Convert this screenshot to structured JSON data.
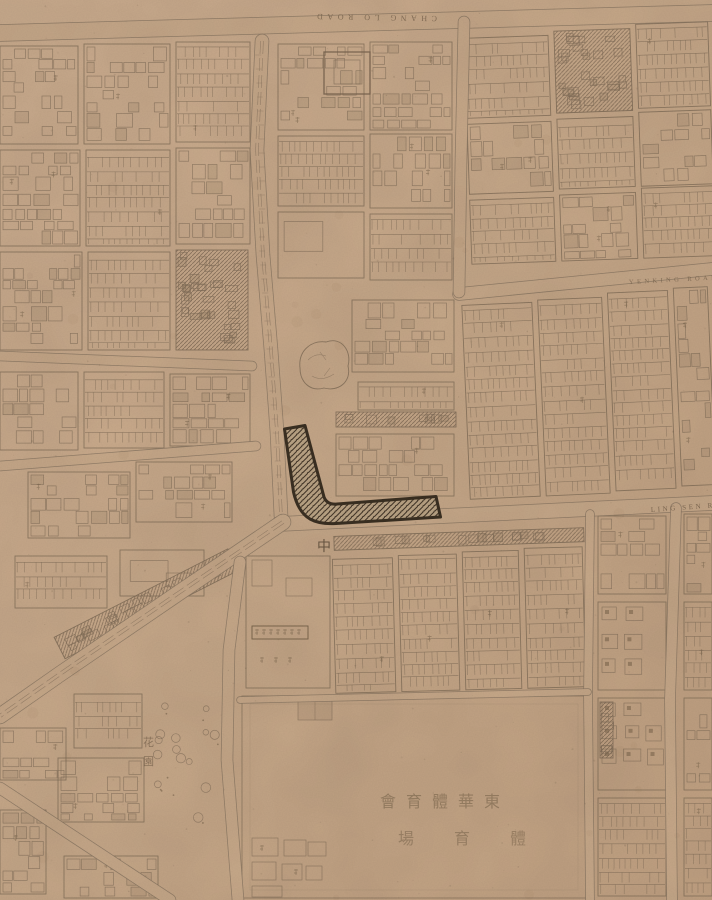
{
  "map": {
    "colors": {
      "paper": "#c9aa8b",
      "paper_light": "#cfb194",
      "paper_dark": "#c1a181",
      "ink": "#85715b",
      "ink_faint": "#9a876f",
      "ink_dark": "#6a573f",
      "highlight_outline": "#3c3123",
      "highlight_hatch": "#46392a",
      "highlight_fill": "#bda687",
      "label_latin": "#7c6750",
      "label_cn": "#6e5a45"
    },
    "labels": [
      {
        "id": "road-chang-lo",
        "text": "CHANG LO ROAD",
        "x": 437,
        "y": 16,
        "rot": 181,
        "size": 8,
        "ls": 4.5,
        "color": "#7c6750",
        "opacity": 0.85
      },
      {
        "id": "road-yenking",
        "text": "YENKING ROAD",
        "x": 629,
        "y": 284,
        "rot": -3,
        "size": 6.5,
        "ls": 3.4,
        "color": "#7c6750",
        "opacity": 0.8
      },
      {
        "id": "road-ling-sen",
        "text": "LING SEN ROAD",
        "x": 651,
        "y": 512,
        "rot": -4.2,
        "size": 7,
        "ls": 2.6,
        "color": "#7c6750",
        "opacity": 0.9
      },
      {
        "id": "road-char-chung",
        "text": "中",
        "x": 317,
        "y": 551,
        "rot": 0,
        "size": 14,
        "ls": 0,
        "color": "#5f4d3a",
        "opacity": 0.85
      },
      {
        "id": "stadium-name-rtl",
        "text": "會育體華東",
        "x": 380,
        "y": 807,
        "rot": 0,
        "size": 16,
        "ls": 10,
        "color": "#8a7358",
        "opacity": 0.7
      },
      {
        "id": "stadium-field-rtl",
        "text": "場育體",
        "x": 398,
        "y": 844,
        "rot": 0,
        "size": 16,
        "ls": 40,
        "color": "#8a7358",
        "opacity": 0.65
      },
      {
        "id": "garden",
        "text": "花園",
        "x": 143,
        "y": 746,
        "rot": 0,
        "size": 11,
        "ls": 0,
        "color": "#6e5a45",
        "opacity": 0.6,
        "vertical": true
      }
    ],
    "highlight": {
      "id": "selected-parcel",
      "shape": "L-shaped hatched building at road junction",
      "path": "M 284.5 429 L 293.5 492 Q 298 512 310 519 Q 320 524.5 336 523.5 L 440.5 517 L 436 496.5 L 337 504 Q 327 505 324 497 L 305 425.5 Z"
    }
  }
}
